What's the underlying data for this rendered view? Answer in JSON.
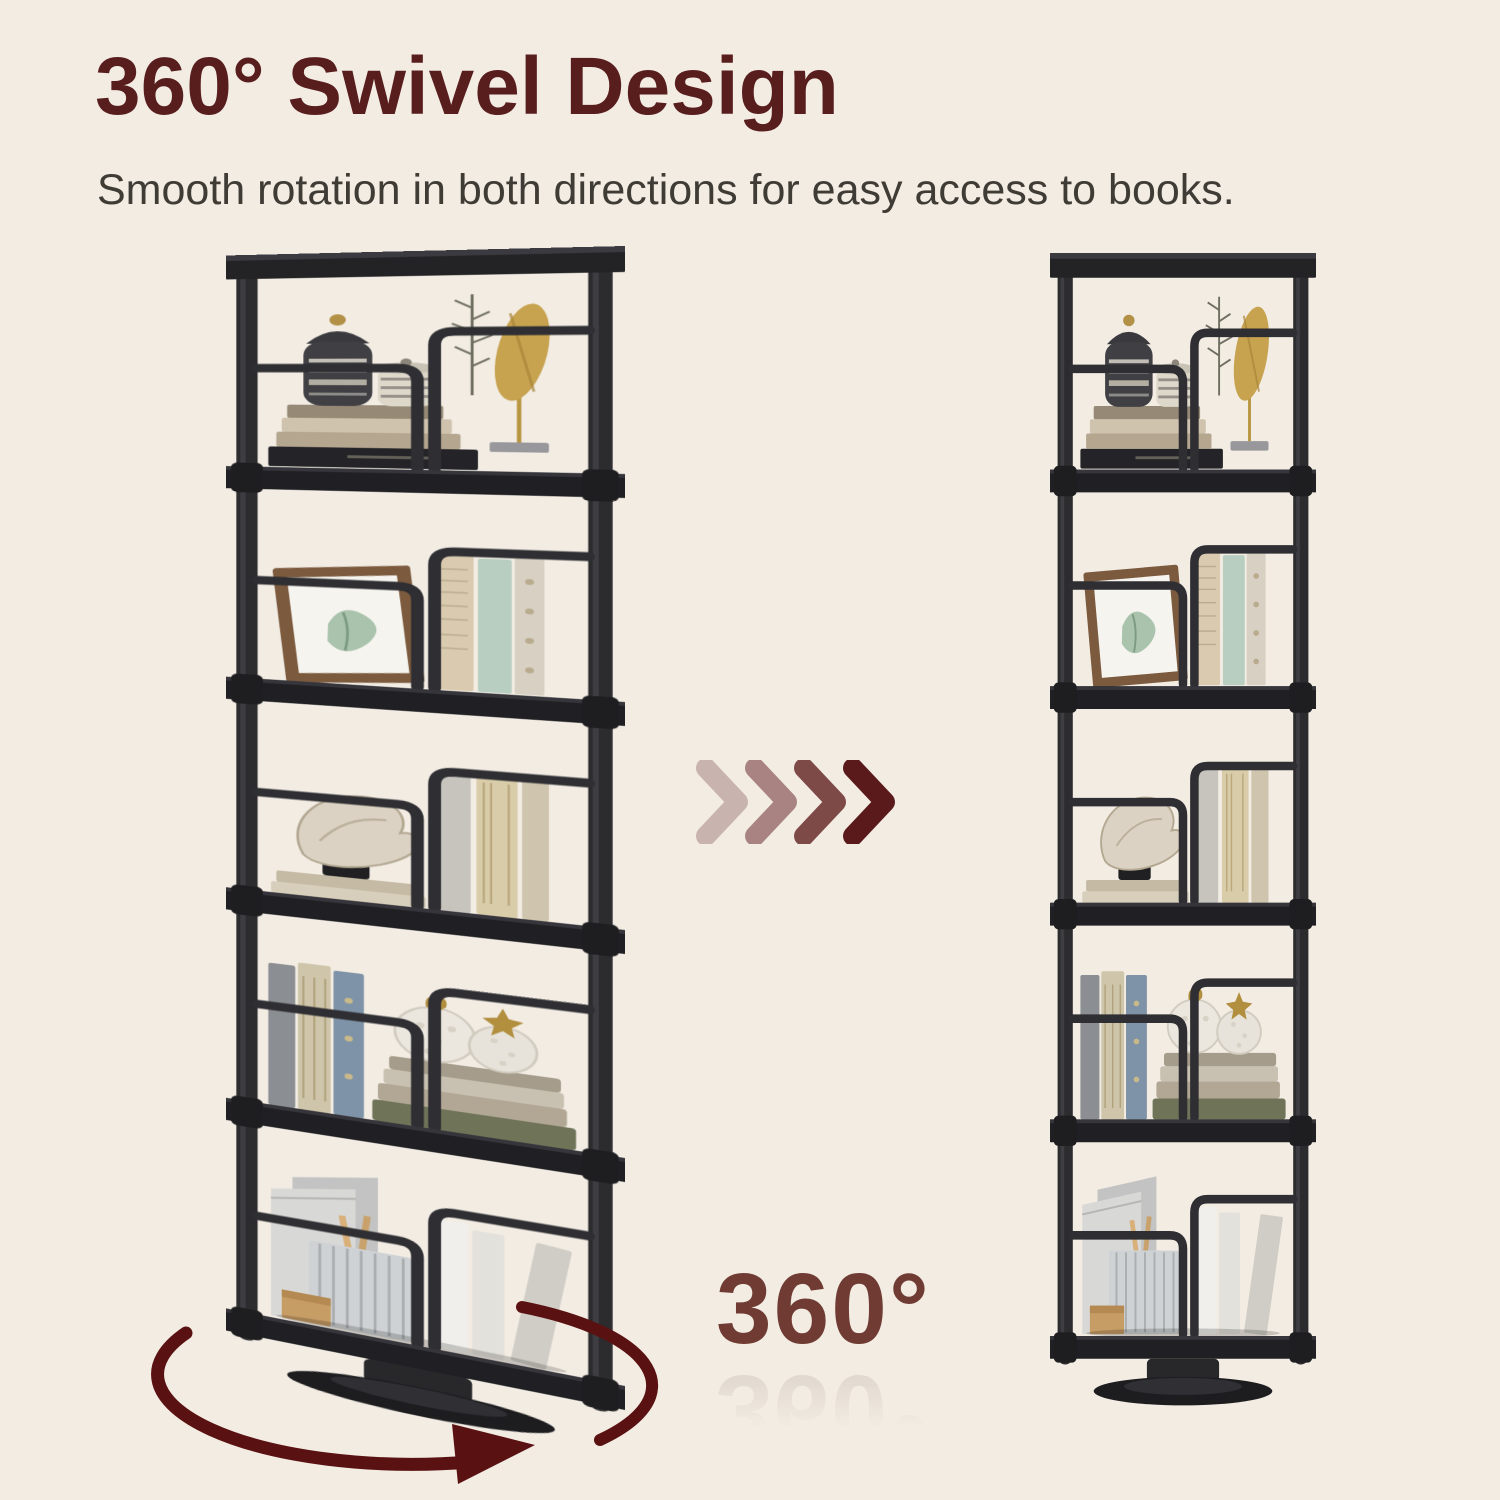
{
  "colors": {
    "background": "#f2ece3",
    "title": "#581d1d",
    "subtitle": "#3f3b35",
    "rotation_label": "#6f3b33",
    "swivel_arrow": "#5a1111",
    "shelf_frame": "#2b2b2e",
    "chevron_1": "#c9b3ae",
    "chevron_2": "#a98381",
    "chevron_3": "#7e4a47",
    "chevron_4": "#5a1a1c"
  },
  "header": {
    "title": "360° Swivel Design",
    "subtitle": "Smooth rotation in both directions for easy access to books."
  },
  "rotation": {
    "label": "360°"
  },
  "shelves": {
    "tier_count": 5,
    "tiers": [
      {
        "items": "decorative urn, striped jar, stacked books, golden leaf ornament, fern sprig"
      },
      {
        "items": "wooden picture frame with leaf artwork, vintage paper-covered books"
      },
      {
        "items": "conch shell sculpture on black stand, antique books, thin book stack"
      },
      {
        "items": "upright books, stacked books, two textured sphere ornaments with gold swan and star"
      },
      {
        "items": "metal magazine files, corrugated file box, pencils, white books, wooden bookend"
      }
    ],
    "left": {
      "view": "angled three-quarter view with swivel arrow"
    },
    "right": {
      "view": "front view"
    }
  }
}
